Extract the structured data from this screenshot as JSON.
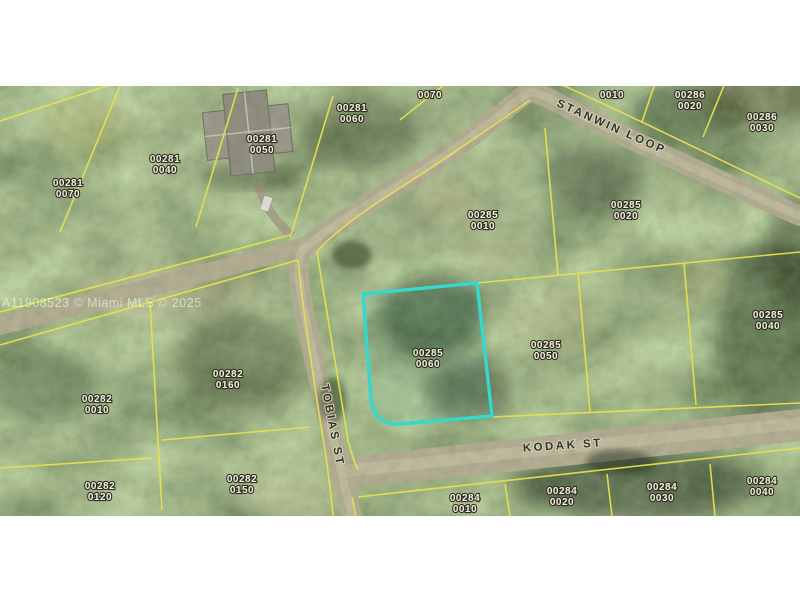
{
  "map": {
    "watermark": "A11908523 © Miami MLS © 2025",
    "highlight": {
      "parcel_id": "00285 0060",
      "color": "#35d8cc"
    },
    "colors": {
      "parcel_line": "#e6e04e",
      "road": "#b6ad94",
      "vegetation_base": "#64734a"
    },
    "streets": [
      {
        "name": "STANWIN LOOP",
        "x": 610,
        "y": 130,
        "rotation": 24,
        "spacing": 2.5
      },
      {
        "name": "TOBIAS ST",
        "x": 329,
        "y": 426,
        "rotation": 79,
        "spacing": 2
      },
      {
        "name": "KODAK ST",
        "x": 563,
        "y": 449,
        "rotation": -4,
        "spacing": 3
      }
    ],
    "parcels": [
      {
        "lines": [
          "00281",
          "0070"
        ],
        "x": 68,
        "y": 188
      },
      {
        "lines": [
          "00281",
          "0040"
        ],
        "x": 165,
        "y": 164
      },
      {
        "lines": [
          "00281",
          "0050"
        ],
        "x": 262,
        "y": 144
      },
      {
        "lines": [
          "00281",
          "0060"
        ],
        "x": 352,
        "y": 113
      },
      {
        "lines": [
          "0070"
        ],
        "x": 430,
        "y": 94
      },
      {
        "lines": [
          "0010"
        ],
        "x": 612,
        "y": 94
      },
      {
        "lines": [
          "00286",
          "0020"
        ],
        "x": 690,
        "y": 100
      },
      {
        "lines": [
          "00286",
          "0030"
        ],
        "x": 762,
        "y": 122
      },
      {
        "lines": [
          "00285",
          "0010"
        ],
        "x": 483,
        "y": 220
      },
      {
        "lines": [
          "00285",
          "0020"
        ],
        "x": 626,
        "y": 210
      },
      {
        "lines": [
          "00285",
          "0060"
        ],
        "x": 428,
        "y": 358,
        "highlighted": true
      },
      {
        "lines": [
          "00285",
          "0050"
        ],
        "x": 546,
        "y": 350
      },
      {
        "lines": [
          "00285",
          "0040"
        ],
        "x": 768,
        "y": 320
      },
      {
        "lines": [
          "00282",
          "0010"
        ],
        "x": 97,
        "y": 404
      },
      {
        "lines": [
          "00282",
          "0160"
        ],
        "x": 228,
        "y": 379
      },
      {
        "lines": [
          "00282",
          "0120"
        ],
        "x": 100,
        "y": 491
      },
      {
        "lines": [
          "00282",
          "0150"
        ],
        "x": 242,
        "y": 484
      },
      {
        "lines": [
          "00284",
          "0010"
        ],
        "x": 465,
        "y": 503
      },
      {
        "lines": [
          "00284",
          "0020"
        ],
        "x": 562,
        "y": 496
      },
      {
        "lines": [
          "00284",
          "0030"
        ],
        "x": 662,
        "y": 492
      },
      {
        "lines": [
          "00284",
          "0040"
        ],
        "x": 762,
        "y": 486
      }
    ]
  }
}
